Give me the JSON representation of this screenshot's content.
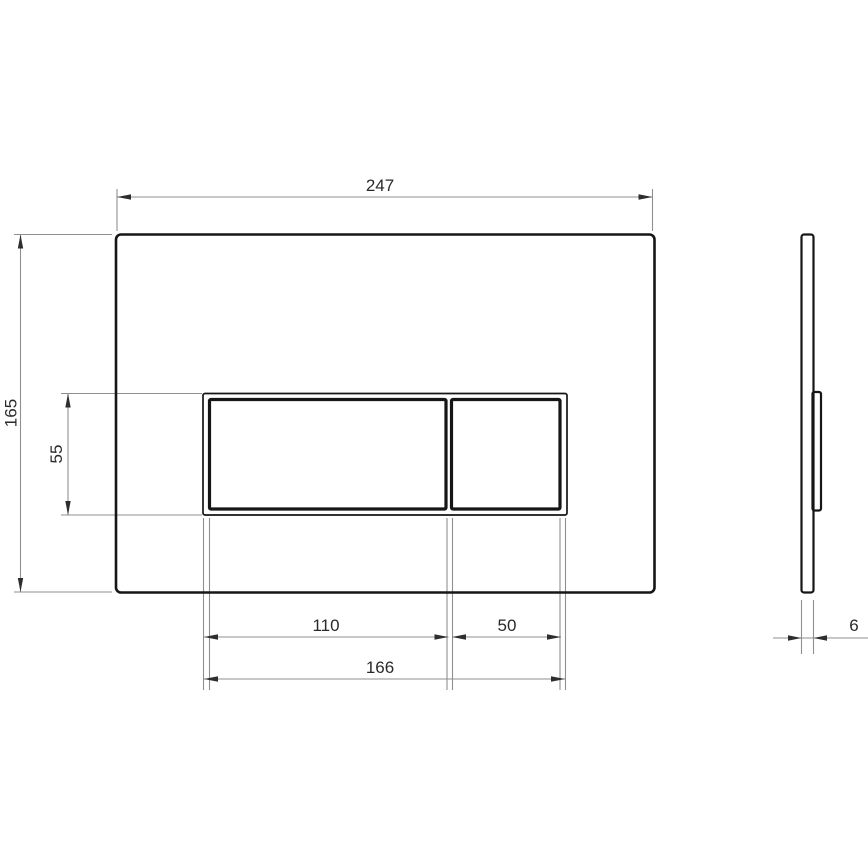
{
  "dimensions": {
    "plate_width": "247",
    "plate_height": "165",
    "button_panel_height": "55",
    "large_button_width": "110",
    "small_button_width": "50",
    "button_panel_width": "166",
    "plate_thickness": "6"
  },
  "colors": {
    "outline": "#161616",
    "dimension_line": "#8f8f8f",
    "arrowhead": "#2e2e2e",
    "text": "#2a2a2a",
    "background": "#ffffff"
  }
}
